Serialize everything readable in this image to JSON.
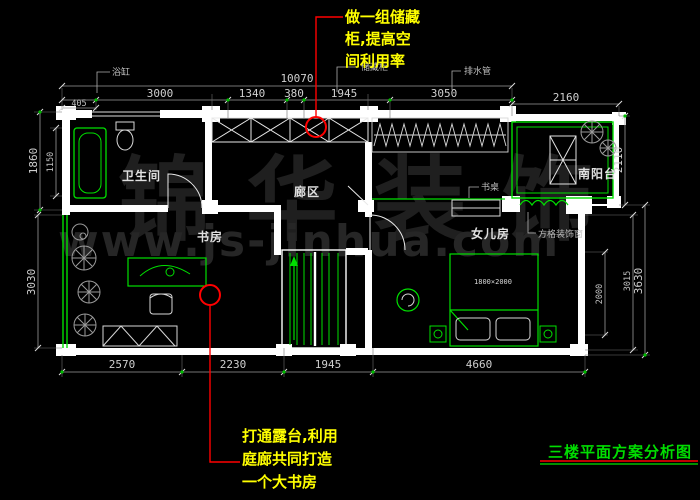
{
  "drawing_title": "三楼平面方案分析图",
  "annotation_top": {
    "line1": "做一组储藏",
    "line2": "柜,提高空",
    "line3": "间利用率"
  },
  "annotation_bottom": {
    "line1": "打通露台,利用",
    "line2": "庭廊共同打造",
    "line3": "一个大书房"
  },
  "rooms": {
    "bathroom": "卫生间",
    "corridor": "廊区",
    "study": "书房",
    "daughter_room": "女儿房",
    "south_balcony": "南阳台"
  },
  "callouts": {
    "bathtub": "浴缸",
    "storage_cabinet": "储藏柜",
    "drain_pipe": "排水管",
    "desk": "书桌",
    "lattice_window": "方格装饰窗"
  },
  "bed_size_label": "1800×2000",
  "dimensions": {
    "top_total": "10070",
    "top_segments": [
      "3000",
      "1340",
      "380",
      "1945",
      "3050"
    ],
    "top_right": "2160",
    "top_small": "405",
    "left": [
      "1860",
      "1150",
      "3030"
    ],
    "right": [
      "2110",
      "3630",
      "3015",
      "2000"
    ],
    "bottom": [
      "2570",
      "2230",
      "1945",
      "4660"
    ]
  },
  "watermark": {
    "brand": "锦华装饰",
    "url": "www.js-jinhua.com"
  },
  "colors": {
    "background": "#000000",
    "wall": "#ffffff",
    "furniture_green": "#00e000",
    "dimension_gray": "#cfcfcf",
    "annotation_red": "#ff0000",
    "annotation_yellow": "#ffff00",
    "title_green": "#00dd00"
  }
}
